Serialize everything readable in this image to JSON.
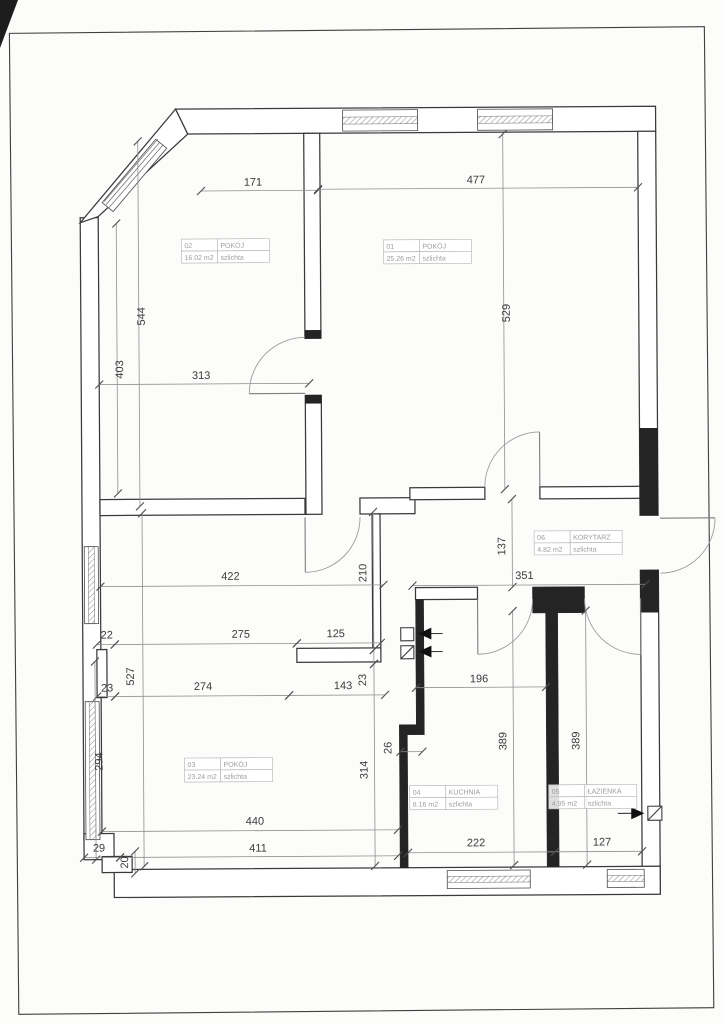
{
  "drawing": {
    "kind": "floor-plan",
    "finish_note": "szlichta"
  },
  "rooms": [
    {
      "id": "01",
      "name": "POKÓJ",
      "area": "25.26 m2",
      "finish": "szlichta"
    },
    {
      "id": "02",
      "name": "POKÓJ",
      "area": "16.02 m2",
      "finish": "szlichta"
    },
    {
      "id": "03",
      "name": "POKÓJ",
      "area": "23.24 m2",
      "finish": "szlichta"
    },
    {
      "id": "04",
      "name": "KUCHNIA",
      "area": "8.16 m2",
      "finish": "szlichta"
    },
    {
      "id": "05",
      "name": "ŁAZIENKA",
      "area": "4.95 m2",
      "finish": "szlichta"
    },
    {
      "id": "06",
      "name": "KORYTARZ",
      "area": "4.82 m2",
      "finish": "szlichta"
    }
  ],
  "dims": {
    "d171": "171",
    "d477": "477",
    "d544": "544",
    "d529": "529",
    "d403": "403",
    "d313": "313",
    "d422": "422",
    "d210": "210",
    "d137": "137",
    "d351": "351",
    "d22": "22",
    "d275": "275",
    "d125": "125",
    "d527": "527",
    "d23a": "23",
    "d274": "274",
    "d143": "143",
    "d23b": "23",
    "d196": "196",
    "d294": "294",
    "d26": "26",
    "d314": "314",
    "d389a": "389",
    "d389b": "389",
    "d440": "440",
    "d29": "29",
    "d411": "411",
    "d20": "20",
    "d222": "222",
    "d127": "127"
  },
  "colors": {
    "wall_line": "#3a3a3a",
    "solid_wall": "#242424",
    "dimension_text": "#3c3c3c",
    "room_label_text": "#9c9c9c"
  }
}
